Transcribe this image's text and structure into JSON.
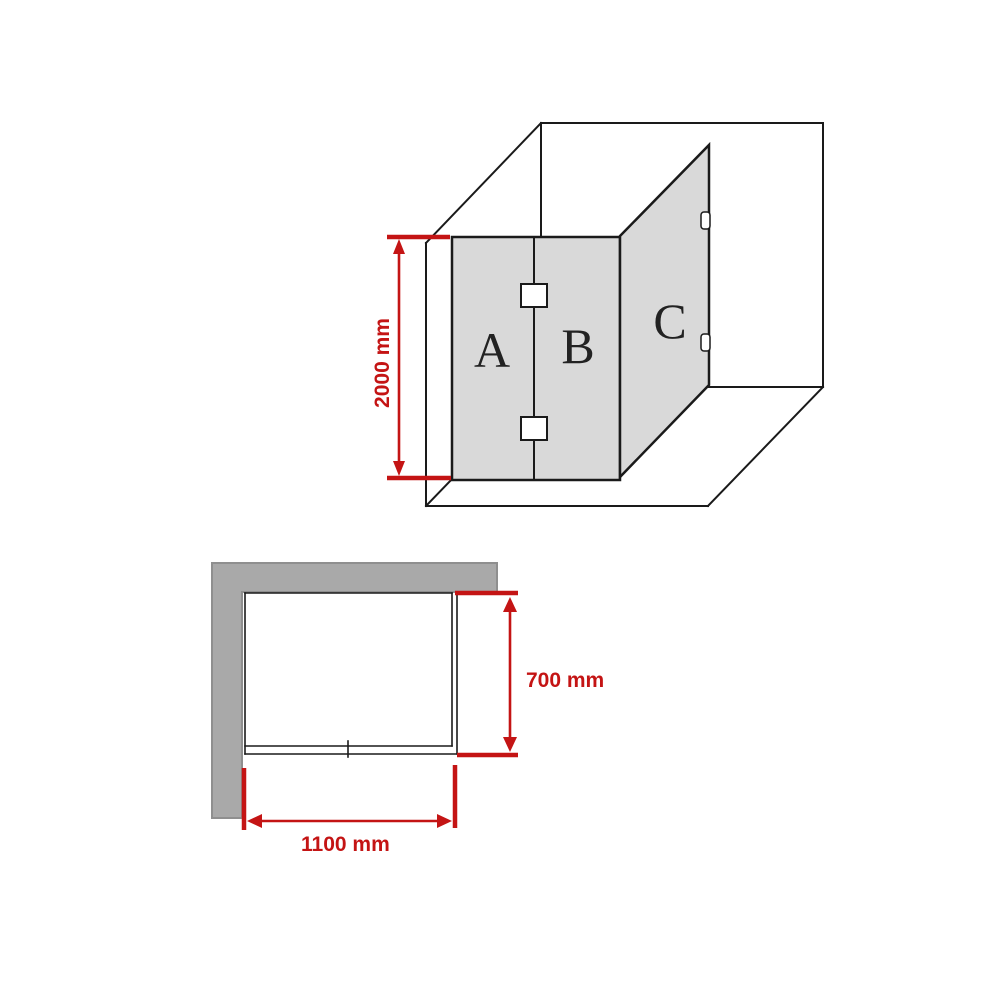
{
  "iso_view": {
    "panel_labels": {
      "a": "A",
      "b": "B",
      "c": "C"
    },
    "height_dimension_label": "2000 mm"
  },
  "plan_view": {
    "depth_dimension_label": "700 mm",
    "width_dimension_label": "1100 mm"
  },
  "colors": {
    "dimension_red": "#c41414",
    "panel_fill": "#d9d9d9",
    "wall_grey": "#a9a9a9",
    "wall_grey_edge": "#8f8f8f",
    "line_black": "#1a1a1a",
    "hinge_fill": "#ffffff",
    "letter_color": "#222222"
  }
}
